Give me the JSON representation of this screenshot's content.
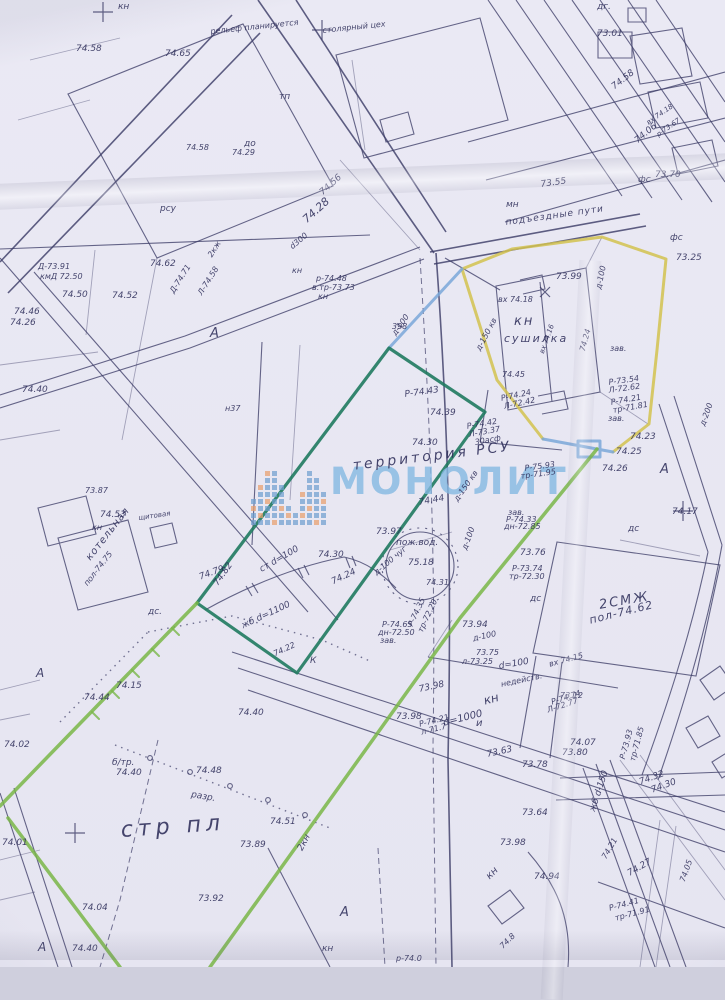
{
  "map": {
    "watermark": {
      "text": "МОНОЛИТ",
      "logo_pattern": [
        "bbob",
        "bobbbo",
        "bbbobbbo",
        "obbbbbbb",
        "bbobbb",
        "bob",
        "bb",
        "bobbo",
        "bbobbbbb",
        "obbbbbb",
        "bbbob"
      ]
    },
    "colors": {
      "ink": "#3d3d68",
      "ink_text": "#2e2e5a",
      "watermark": "#85b9e2",
      "logo_blue": "#6f9fce",
      "logo_orange": "#e8a06c",
      "boundary_teal": "#1f7a5f",
      "boundary_green": "#79b648",
      "boundary_yellow": "#d2c24d",
      "boundary_blue": "#7aa7d8"
    },
    "labels": [
      {
        "t": "кн",
        "x": 118,
        "y": 2
      },
      {
        "t": "столярный цех",
        "x": 322,
        "y": 26,
        "r": -6,
        "s": 8
      },
      {
        "t": "рельеф планируется",
        "x": 210,
        "y": 27,
        "r": -6,
        "s": 8
      },
      {
        "t": "74.65",
        "x": 165,
        "y": 49
      },
      {
        "t": "74.58",
        "x": 76,
        "y": 44
      },
      {
        "t": "тп",
        "x": 279,
        "y": 92
      },
      {
        "t": "до",
        "x": 244,
        "y": 139
      },
      {
        "t": "дг.",
        "x": 597,
        "y": 2
      },
      {
        "t": "73.01",
        "x": 597,
        "y": 29
      },
      {
        "t": "74.58",
        "x": 610,
        "y": 84,
        "r": -38
      },
      {
        "t": "74.06",
        "x": 633,
        "y": 138,
        "r": -40
      },
      {
        "t": "73.55",
        "x": 540,
        "y": 180,
        "r": -8
      },
      {
        "t": "подъездные пути",
        "x": 505,
        "y": 218,
        "r": -8,
        "ls": 1
      },
      {
        "t": "мн",
        "x": 506,
        "y": 200
      },
      {
        "t": "фс",
        "x": 638,
        "y": 175
      },
      {
        "t": "фс",
        "x": 670,
        "y": 233
      },
      {
        "t": "73.25",
        "x": 676,
        "y": 253
      },
      {
        "t": "вх 74.18",
        "x": 645,
        "y": 120,
        "r": -35,
        "s": 7
      },
      {
        "t": "р-73.67",
        "x": 655,
        "y": 132,
        "r": -35,
        "s": 7
      },
      {
        "t": "73.70",
        "x": 655,
        "y": 170
      },
      {
        "t": "рсу",
        "x": 160,
        "y": 204
      },
      {
        "t": "74.58",
        "x": 186,
        "y": 143,
        "s": 8
      },
      {
        "t": "74.29",
        "x": 232,
        "y": 148,
        "s": 8
      },
      {
        "t": "74.28",
        "x": 300,
        "y": 216,
        "r": -42,
        "s": 11
      },
      {
        "t": "74.56",
        "x": 318,
        "y": 190,
        "r": -42
      },
      {
        "t": "d300",
        "x": 288,
        "y": 244,
        "r": -40,
        "s": 8
      },
      {
        "t": "кн",
        "x": 292,
        "y": 266,
        "s": 8
      },
      {
        "t": "р-74.48",
        "x": 316,
        "y": 274,
        "s": 8
      },
      {
        "t": "в.тр-73.73",
        "x": 312,
        "y": 283,
        "s": 8
      },
      {
        "t": "кн",
        "x": 318,
        "y": 292,
        "s": 8
      },
      {
        "t": "398",
        "x": 392,
        "y": 322,
        "s": 8
      },
      {
        "t": "д-100",
        "x": 390,
        "y": 332,
        "r": -55,
        "s": 8
      },
      {
        "t": "Д-73.91",
        "x": 38,
        "y": 262,
        "s": 8
      },
      {
        "t": "кмД 72.50",
        "x": 40,
        "y": 272,
        "s": 8
      },
      {
        "t": "74.62",
        "x": 150,
        "y": 259
      },
      {
        "t": "74.50",
        "x": 62,
        "y": 290
      },
      {
        "t": "74.52",
        "x": 112,
        "y": 291
      },
      {
        "t": "74.46",
        "x": 14,
        "y": 307
      },
      {
        "t": "74.26",
        "x": 10,
        "y": 318
      },
      {
        "t": "Д-74.71",
        "x": 168,
        "y": 290,
        "r": -58,
        "s": 8
      },
      {
        "t": "Л-74.58",
        "x": 196,
        "y": 292,
        "r": -58,
        "s": 8
      },
      {
        "t": "2кж",
        "x": 206,
        "y": 254,
        "r": -58,
        "s": 8
      },
      {
        "t": "А",
        "x": 210,
        "y": 326,
        "s": 13
      },
      {
        "t": "74.40",
        "x": 22,
        "y": 385
      },
      {
        "t": "н37",
        "x": 225,
        "y": 404,
        "s": 8
      },
      {
        "t": "73.87",
        "x": 85,
        "y": 486,
        "s": 8
      },
      {
        "t": "кн",
        "x": 92,
        "y": 523,
        "s": 8
      },
      {
        "t": "74.53",
        "x": 100,
        "y": 510
      },
      {
        "t": "щитовая",
        "x": 138,
        "y": 514,
        "r": -8,
        "s": 7
      },
      {
        "t": "котельная",
        "x": 84,
        "y": 556,
        "r": -52,
        "s": 10,
        "ls": 1
      },
      {
        "t": "пол-74.75",
        "x": 82,
        "y": 582,
        "r": -52,
        "s": 8
      },
      {
        "t": "дс.",
        "x": 148,
        "y": 607
      },
      {
        "t": "74.79",
        "x": 198,
        "y": 573,
        "r": -20
      },
      {
        "t": "74.82",
        "x": 212,
        "y": 582,
        "r": -55
      },
      {
        "t": "74.15",
        "x": 116,
        "y": 681
      },
      {
        "t": "74.44",
        "x": 84,
        "y": 693
      },
      {
        "t": "74.02",
        "x": 4,
        "y": 740
      },
      {
        "t": "А",
        "x": 36,
        "y": 666,
        "s": 12
      },
      {
        "t": "территория РСУ",
        "x": 352,
        "y": 458,
        "r": -7,
        "s": 14,
        "ls": 3
      },
      {
        "t": "Р-74.43",
        "x": 404,
        "y": 390,
        "r": -8
      },
      {
        "t": "74.39",
        "x": 430,
        "y": 408
      },
      {
        "t": "74.30",
        "x": 412,
        "y": 438
      },
      {
        "t": "74.44",
        "x": 418,
        "y": 498,
        "r": -10
      },
      {
        "t": "Р-74.42",
        "x": 466,
        "y": 422,
        "r": -10,
        "s": 8
      },
      {
        "t": "Л-73.37",
        "x": 468,
        "y": 430,
        "r": -10,
        "s": 8
      },
      {
        "t": "30асф",
        "x": 474,
        "y": 438,
        "r": -10,
        "s": 8
      },
      {
        "t": "Р-74.24",
        "x": 500,
        "y": 394,
        "r": -12,
        "s": 8
      },
      {
        "t": "Л-72.42",
        "x": 503,
        "y": 402,
        "r": -12,
        "s": 8
      },
      {
        "t": "Р-75.93",
        "x": 524,
        "y": 464,
        "r": -8,
        "s": 8
      },
      {
        "t": "тр-71.95",
        "x": 520,
        "y": 472,
        "r": -8,
        "s": 8
      },
      {
        "t": "73.99",
        "x": 556,
        "y": 272
      },
      {
        "t": "вх 74.18",
        "x": 498,
        "y": 295,
        "s": 8
      },
      {
        "t": "кн",
        "x": 514,
        "y": 314,
        "s": 13,
        "ls": 2
      },
      {
        "t": "сушилка",
        "x": 504,
        "y": 332,
        "s": 11,
        "ls": 2
      },
      {
        "t": "д-100",
        "x": 594,
        "y": 288,
        "r": -78,
        "s": 8
      },
      {
        "t": "зав.",
        "x": 610,
        "y": 344,
        "s": 8
      },
      {
        "t": "д-150 кв",
        "x": 474,
        "y": 348,
        "r": -62,
        "s": 8
      },
      {
        "t": "74.24",
        "x": 578,
        "y": 350,
        "r": -75,
        "s": 8
      },
      {
        "t": "вх 74.16",
        "x": 538,
        "y": 352,
        "r": -70,
        "s": 7
      },
      {
        "t": "74.45",
        "x": 502,
        "y": 370,
        "s": 8
      },
      {
        "t": "Р-73.54",
        "x": 608,
        "y": 378,
        "r": -8,
        "s": 8
      },
      {
        "t": "Л-72.62",
        "x": 608,
        "y": 386,
        "r": -8,
        "s": 8
      },
      {
        "t": "Р-74.21",
        "x": 610,
        "y": 398,
        "r": -10,
        "s": 8
      },
      {
        "t": "тр-71.81",
        "x": 612,
        "y": 406,
        "r": -10,
        "s": 8
      },
      {
        "t": "зав.",
        "x": 608,
        "y": 414,
        "s": 8
      },
      {
        "t": "74.23",
        "x": 630,
        "y": 432
      },
      {
        "t": "74.25",
        "x": 616,
        "y": 447
      },
      {
        "t": "74.26",
        "x": 602,
        "y": 464
      },
      {
        "t": "А",
        "x": 660,
        "y": 462,
        "s": 13
      },
      {
        "t": "д-200",
        "x": 698,
        "y": 424,
        "r": -70,
        "s": 8
      },
      {
        "t": "74.17",
        "x": 672,
        "y": 507
      },
      {
        "t": "дс",
        "x": 628,
        "y": 524
      },
      {
        "t": "73.97",
        "x": 376,
        "y": 527
      },
      {
        "t": "пож.вод.",
        "x": 396,
        "y": 538
      },
      {
        "t": "75.18",
        "x": 408,
        "y": 558
      },
      {
        "t": "74.31",
        "x": 426,
        "y": 578,
        "s": 8
      },
      {
        "t": "д-100 чуг",
        "x": 372,
        "y": 570,
        "r": -40,
        "s": 8
      },
      {
        "t": "д-150 кв",
        "x": 452,
        "y": 498,
        "r": -55,
        "s": 8
      },
      {
        "t": "д-100",
        "x": 460,
        "y": 548,
        "r": -70,
        "s": 8
      },
      {
        "t": "зав.",
        "x": 508,
        "y": 508,
        "s": 8
      },
      {
        "t": "Р-74.33",
        "x": 506,
        "y": 515,
        "s": 8
      },
      {
        "t": "дн-72.85",
        "x": 504,
        "y": 522,
        "s": 8
      },
      {
        "t": "74.30",
        "x": 318,
        "y": 550
      },
      {
        "t": "ст d=100",
        "x": 258,
        "y": 566,
        "r": -30
      },
      {
        "t": "74.24",
        "x": 330,
        "y": 578,
        "r": -25
      },
      {
        "t": "жб d=1100",
        "x": 240,
        "y": 622,
        "r": -25
      },
      {
        "t": "74.22",
        "x": 272,
        "y": 650,
        "r": -25,
        "s": 8
      },
      {
        "t": "К",
        "x": 310,
        "y": 656
      },
      {
        "t": "73.76",
        "x": 520,
        "y": 548
      },
      {
        "t": "Р-73.74",
        "x": 512,
        "y": 564,
        "s": 8
      },
      {
        "t": "тр-72.30",
        "x": 509,
        "y": 572,
        "s": 8
      },
      {
        "t": "2СМЖ",
        "x": 598,
        "y": 598,
        "r": -10,
        "s": 13,
        "ls": 2
      },
      {
        "t": "пол-74.62",
        "x": 588,
        "y": 614,
        "r": -14,
        "s": 11,
        "ls": 1
      },
      {
        "t": "дс",
        "x": 530,
        "y": 594
      },
      {
        "t": "Р-74.65",
        "x": 382,
        "y": 620,
        "s": 8
      },
      {
        "t": "дн-72.50",
        "x": 378,
        "y": 628,
        "s": 8
      },
      {
        "t": "зав.",
        "x": 380,
        "y": 636,
        "s": 8
      },
      {
        "t": "Р-74.35",
        "x": 406,
        "y": 624,
        "r": -65,
        "s": 8
      },
      {
        "t": "тр-72.20",
        "x": 416,
        "y": 630,
        "r": -65,
        "s": 8
      },
      {
        "t": "73.94",
        "x": 462,
        "y": 620
      },
      {
        "t": "д-100",
        "x": 472,
        "y": 634,
        "r": -12,
        "s": 8
      },
      {
        "t": "73.75",
        "x": 476,
        "y": 648,
        "s": 8
      },
      {
        "t": "л-73.25",
        "x": 462,
        "y": 657,
        "s": 8
      },
      {
        "t": "d=100",
        "x": 498,
        "y": 662,
        "r": -10
      },
      {
        "t": "недейств.",
        "x": 500,
        "y": 680,
        "r": -12,
        "s": 8
      },
      {
        "t": "вх 74.15",
        "x": 548,
        "y": 660,
        "r": -15,
        "s": 8
      },
      {
        "t": "73.12",
        "x": 560,
        "y": 691,
        "s": 8
      },
      {
        "t": "Р-74.74",
        "x": 550,
        "y": 698,
        "r": -18,
        "s": 8
      },
      {
        "t": "Л-72.77",
        "x": 546,
        "y": 706,
        "r": -18,
        "s": 8
      },
      {
        "t": "73.98",
        "x": 418,
        "y": 685,
        "r": -12
      },
      {
        "t": "73.98",
        "x": 396,
        "y": 712
      },
      {
        "t": "кн",
        "x": 482,
        "y": 694,
        "r": -15,
        "s": 12
      },
      {
        "t": "и",
        "x": 476,
        "y": 718,
        "s": 10
      },
      {
        "t": "d=1000",
        "x": 442,
        "y": 718,
        "r": -14,
        "s": 10
      },
      {
        "t": "Р-74.21",
        "x": 418,
        "y": 720,
        "r": -14,
        "s": 8
      },
      {
        "t": "л-71.7",
        "x": 420,
        "y": 728,
        "r": -14,
        "s": 8
      },
      {
        "t": "73.63",
        "x": 486,
        "y": 750,
        "r": -12
      },
      {
        "t": "73.78",
        "x": 522,
        "y": 760
      },
      {
        "t": "74.07",
        "x": 570,
        "y": 738
      },
      {
        "t": "73.80",
        "x": 562,
        "y": 748
      },
      {
        "t": "Р-73.93",
        "x": 618,
        "y": 758,
        "r": -75,
        "s": 8
      },
      {
        "t": "тр-71.85",
        "x": 628,
        "y": 760,
        "r": -75,
        "s": 8
      },
      {
        "t": "74.32",
        "x": 638,
        "y": 778,
        "r": -20
      },
      {
        "t": "74.30",
        "x": 650,
        "y": 786,
        "r": -20
      },
      {
        "t": "жб d-150",
        "x": 588,
        "y": 810,
        "r": -72
      },
      {
        "t": "74.21",
        "x": 600,
        "y": 856,
        "r": -60,
        "s": 8
      },
      {
        "t": "74.27",
        "x": 626,
        "y": 870,
        "r": -30
      },
      {
        "t": "74.05",
        "x": 678,
        "y": 880,
        "r": -70,
        "s": 8
      },
      {
        "t": "Р-74.41",
        "x": 608,
        "y": 904,
        "r": -15,
        "s": 8
      },
      {
        "t": "тр-71.91",
        "x": 614,
        "y": 914,
        "r": -15,
        "s": 8
      },
      {
        "t": "73.64",
        "x": 522,
        "y": 808
      },
      {
        "t": "73.98",
        "x": 500,
        "y": 838
      },
      {
        "t": "74.94",
        "x": 534,
        "y": 872
      },
      {
        "t": "кн",
        "x": 484,
        "y": 874,
        "r": -45,
        "s": 10
      },
      {
        "t": "2кн",
        "x": 296,
        "y": 848,
        "r": -62
      },
      {
        "t": "А",
        "x": 340,
        "y": 905,
        "s": 13
      },
      {
        "t": "кн",
        "x": 322,
        "y": 944
      },
      {
        "t": "р-74.0",
        "x": 396,
        "y": 954,
        "s": 8
      },
      {
        "t": "74.8",
        "x": 498,
        "y": 944,
        "r": -45,
        "s": 8
      },
      {
        "t": "стр пл",
        "x": 120,
        "y": 818,
        "r": -4,
        "s": 22,
        "ls": 5
      },
      {
        "t": "б/тр.",
        "x": 112,
        "y": 758
      },
      {
        "t": "74.40",
        "x": 116,
        "y": 768
      },
      {
        "t": "разр.",
        "x": 192,
        "y": 790,
        "r": 10
      },
      {
        "t": "74.48",
        "x": 196,
        "y": 766
      },
      {
        "t": "74.40",
        "x": 238,
        "y": 708
      },
      {
        "t": "74.51",
        "x": 270,
        "y": 817
      },
      {
        "t": "73.89",
        "x": 240,
        "y": 840
      },
      {
        "t": "74.04",
        "x": 82,
        "y": 903
      },
      {
        "t": "74.01",
        "x": 2,
        "y": 838
      },
      {
        "t": "73.92",
        "x": 198,
        "y": 894
      },
      {
        "t": "74.40",
        "x": 72,
        "y": 944
      },
      {
        "t": "А",
        "x": 38,
        "y": 940,
        "s": 12
      }
    ]
  }
}
